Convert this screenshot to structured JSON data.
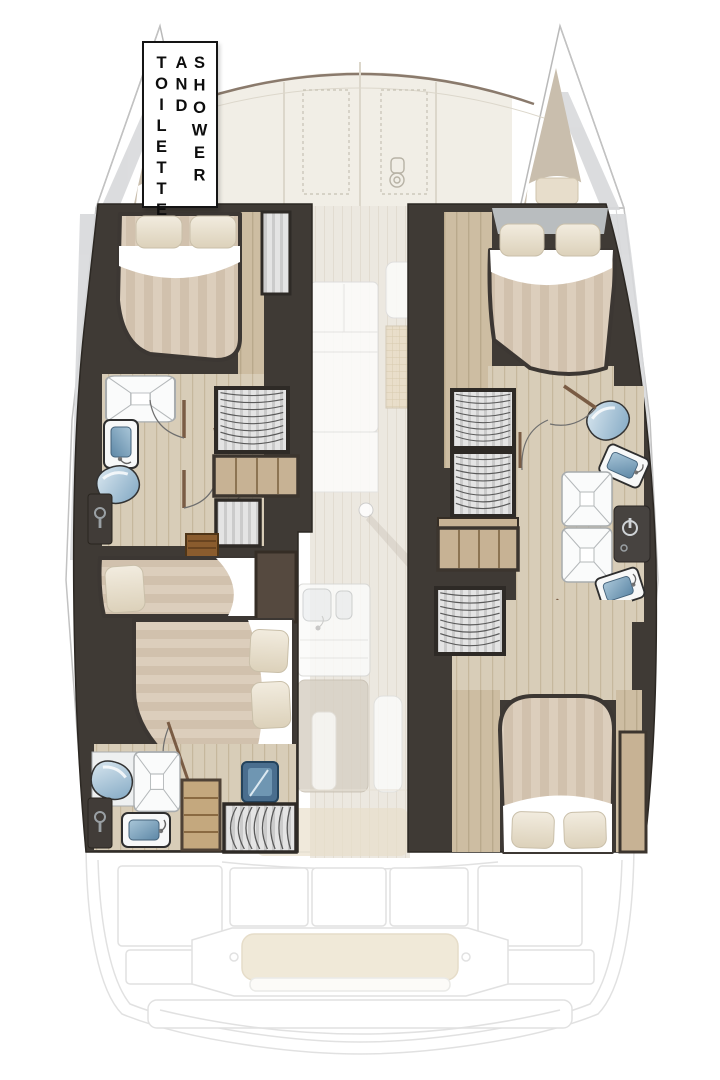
{
  "sign": {
    "words": [
      "TOILETTE",
      "AND",
      "SHOWER"
    ]
  },
  "palette": {
    "wall_dark": "#3f3a35",
    "door_wood": "#7a5c44",
    "floor_wood": "#cdbda2",
    "floor_wood_line": "#b9a98c",
    "mattress_stripe_a": "#dccebc",
    "mattress_stripe_b": "#d1c1ad",
    "pillow_cream": "#ece3d2",
    "fixture_blue": "#7fa6c2",
    "deck_cream": "#f1eee6",
    "cockpit_cushion": "#ece2cc",
    "marble_gray": "#d8d9db",
    "ghost_outline": "#d8d8d8"
  },
  "features": [
    "double-bed-icon",
    "pillow-icon",
    "single-berth-icon",
    "toilet-icon",
    "washbasin-icon",
    "shower-cabin-icon",
    "hanging-locker-icon",
    "drawer-unit-icon",
    "companionway-steps-icon",
    "door-swing-icon",
    "galley-sink-icon",
    "kitchen-island-icon",
    "salon-sofa-icon",
    "cockpit-bench-icon",
    "bow-trampoline-hatch-icon",
    "windlass-icon",
    "engine-hatch-icon"
  ]
}
